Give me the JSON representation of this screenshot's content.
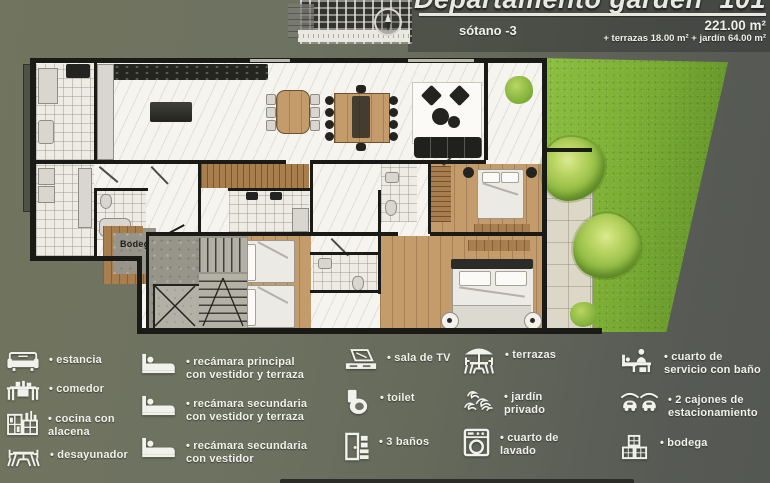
{
  "header": {
    "title": "Departamento garden",
    "unit_number": "101",
    "level": "sótano -3",
    "area_main": "221.00 m²",
    "area_extra": "+ terrazas 18.00 m² + jardín 64.00 m²"
  },
  "plan": {
    "labels": {
      "bodega": "Bodega"
    }
  },
  "legend": {
    "columns": [
      {
        "items": [
          {
            "icon": "sofa-icon",
            "label": "• estancia"
          },
          {
            "icon": "dining-table-icon",
            "label": "• comedor"
          },
          {
            "icon": "kitchen-icon",
            "label": "• cocina con alacena"
          },
          {
            "icon": "breakfast-table-icon",
            "label": "• desayunador"
          }
        ]
      },
      {
        "items": [
          {
            "icon": "bed-icon",
            "label": "• recámara principal con vestidor y terraza"
          },
          {
            "icon": "bed-icon",
            "label": "• recámara secundaria con vestidor y terraza"
          },
          {
            "icon": "bed-icon",
            "label": "• recámara secundaria con vestidor"
          }
        ]
      },
      {
        "items": [
          {
            "icon": "tv-icon",
            "label": "• sala de TV"
          },
          {
            "icon": "toilet-icon",
            "label": "• toilet"
          },
          {
            "icon": "bathroom-icon",
            "label": "• 3 baños"
          }
        ]
      },
      {
        "items": [
          {
            "icon": "terrace-umbrella-icon",
            "label": "• terrazas"
          },
          {
            "icon": "garden-plants-icon",
            "label": "• jardín privado"
          },
          {
            "icon": "washing-machine-icon",
            "label": "• cuarto de lavado"
          }
        ]
      },
      {
        "items": [
          {
            "icon": "service-room-icon",
            "label": "• cuarto de servicio con baño"
          },
          {
            "icon": "parking-cars-icon",
            "label": "• 2 cajones de estacionamiento"
          },
          {
            "icon": "storage-boxes-icon",
            "label": "• bodega"
          }
        ]
      }
    ]
  },
  "colors": {
    "background_olive": "#6e7263",
    "background_gray": "#565954",
    "garden_green": "#7cae36",
    "tree_green": "#a8c94f",
    "wood_floor": "#c49c6c",
    "terrace_tile": "#ddd7c8",
    "wall_black": "#1a1b16",
    "floor_white": "#f6f4ef",
    "legend_white": "#f1f2ec"
  }
}
